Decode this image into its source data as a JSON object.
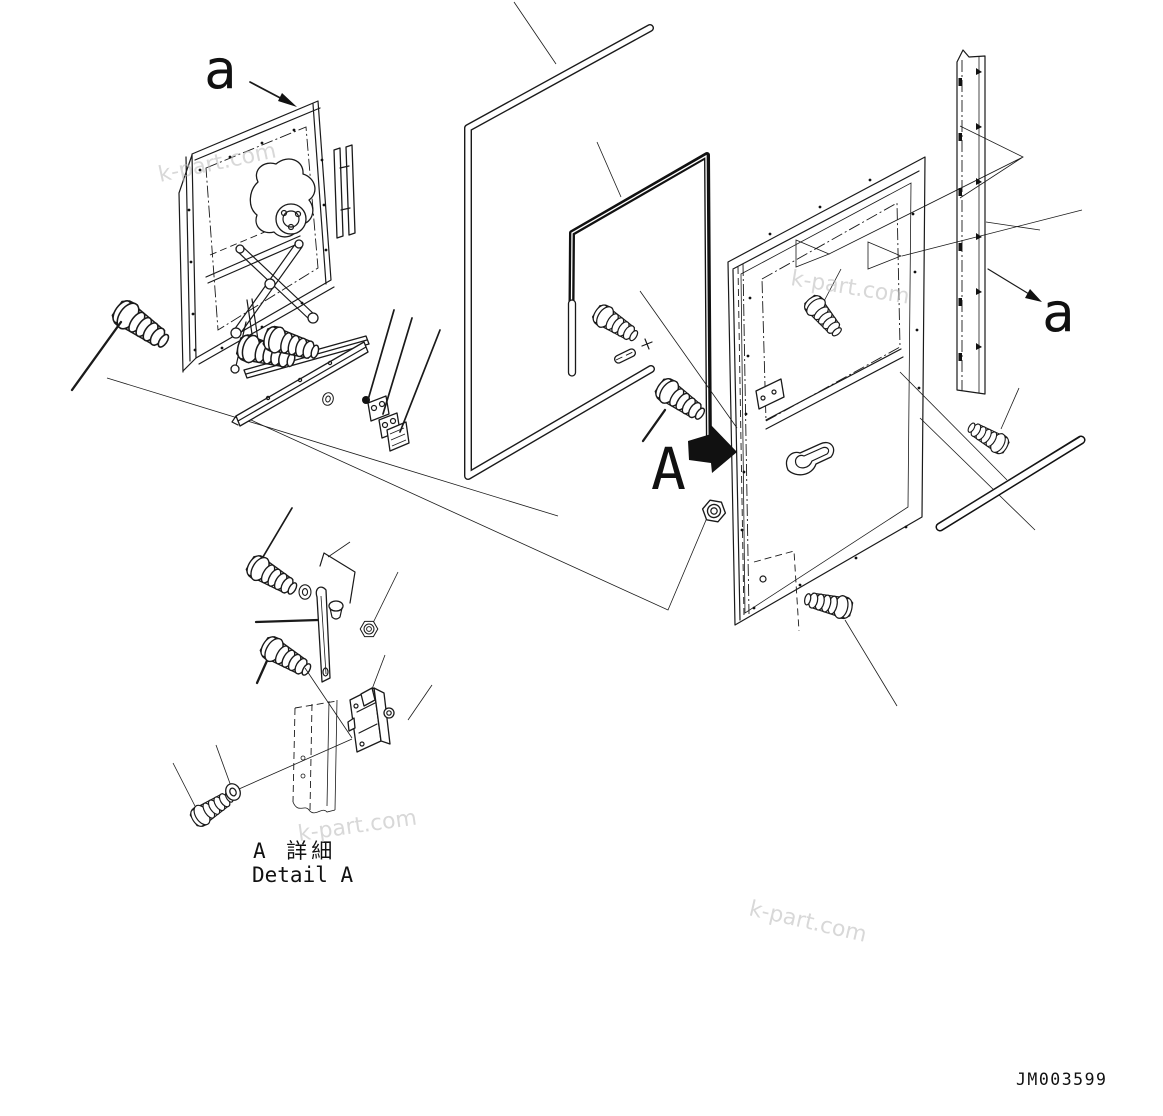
{
  "diagram": {
    "view_label_left": "a",
    "view_label_right": "a",
    "detail_marker": "A",
    "detail_title_jp": "A 詳細",
    "detail_title_en": "Detail A",
    "drawing_number": "JM003599"
  },
  "watermark": {
    "text": "k-part.com",
    "color": "#b9b9b9"
  },
  "colors": {
    "line": "#1a1a1a",
    "background": "#ffffff"
  }
}
